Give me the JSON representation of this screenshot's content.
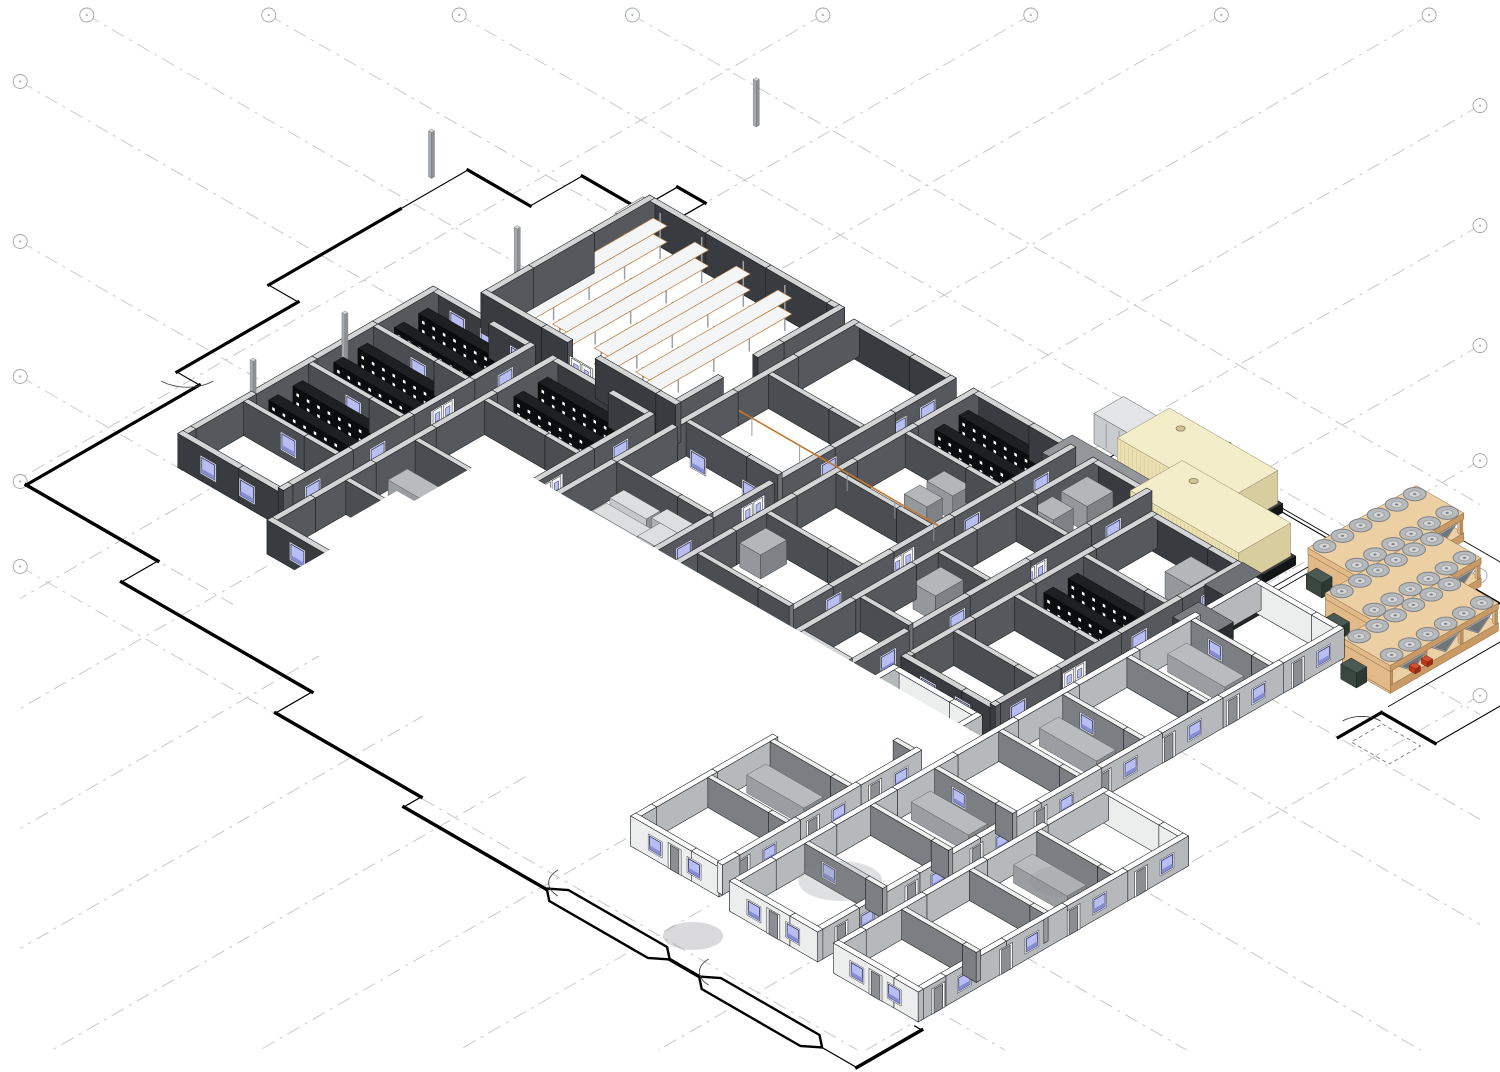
{
  "meta": {
    "title": "Isometric 3D cutaway view of a single-storey facility BIM model",
    "background": "#ffffff",
    "canvas": {
      "width": 1500,
      "height": 1072
    }
  },
  "palette": {
    "background": "#ffffff",
    "grid_line": "#c6c8cc",
    "plan_line": "#000000",
    "dark_wall_face": "#383c40",
    "dark_wall_end": "#55595d",
    "dark_wall_top": "#d2d4d6",
    "dark_partition_face": "#4a4e52",
    "dark_partition_end": "#6e7276",
    "light_wall_face": "#eceded",
    "light_wall_end": "#b6b9bc",
    "light_wall_top": "#ffffff",
    "light_partition_face": "#7b7f83",
    "light_partition_end": "#979b9f",
    "floor": "#ffffff",
    "window_glass": "#b9bef2",
    "window_trim": "#f6f7f9",
    "window_frame": "#2e3260",
    "window_shade": "#868cd2",
    "door_white": "#f4f5f6",
    "door_gray": "#8b8f93",
    "rack_black": "#0b0c0e",
    "rack_black_top": "#1d1f22",
    "rack_tick": "#ffffff",
    "shelf_orange": "#c4782e",
    "shelf_post": "#9aa0a6",
    "shelf_board": "#f4f5f6",
    "generator_body": "#eae0b2",
    "generator_end": "#d8cd9e",
    "generator_top": "#f3edc9",
    "generator_plinth": "#1c1e20",
    "switchgear_face": "#44484c",
    "switchgear_end": "#2f3236",
    "switchgear_top": "#93979b",
    "ahu_face": "#c9ccce",
    "ahu_end": "#aeb1b4",
    "ahu_top": "#e3e5e7",
    "chiller_face": "#e2b988",
    "chiller_end": "#c99a66",
    "chiller_top": "#edcfa4",
    "chiller_fan": "#b7babd",
    "chiller_fan_hub": "#d3d5d7",
    "chiller_coil": "#9da2a6",
    "chiller_pump": "#39473f",
    "chiller_accent": "#c6341c",
    "bench_gray": "#b9bcbf",
    "cabinet_gray": "#94989c",
    "column_gray": "#a7abaf",
    "tray_orange": "#c4782e"
  },
  "scene": {
    "grid": {
      "x_positions": [
        -80,
        40,
        150,
        270,
        390,
        510,
        630,
        745,
        860,
        980
      ],
      "y_positions": [
        -60,
        40,
        150,
        255,
        360,
        520,
        655,
        760,
        845
      ],
      "bubble_radius": 7,
      "dash": "14 6 3 6"
    },
    "site": {
      "door_swings": 4,
      "vestibules": 2,
      "hatch_lines": 13
    },
    "warehouse": {
      "rack_rows": 4,
      "rack_levels": 2,
      "posts_per_row": 5
    },
    "dark_building": {
      "bays": 6,
      "server_rack_rows": 10,
      "lab_benches": 6,
      "cable_tray": 1
    },
    "light_building": {
      "bays": 3,
      "benches": 6
    },
    "plant_yard": {
      "generators": 2,
      "switchgear_panel_cells": 7,
      "ahu_units": 1,
      "chillers": 3,
      "chiller_fan_rows": 2,
      "chiller_fans_per_row": 6
    },
    "columns": 5
  }
}
